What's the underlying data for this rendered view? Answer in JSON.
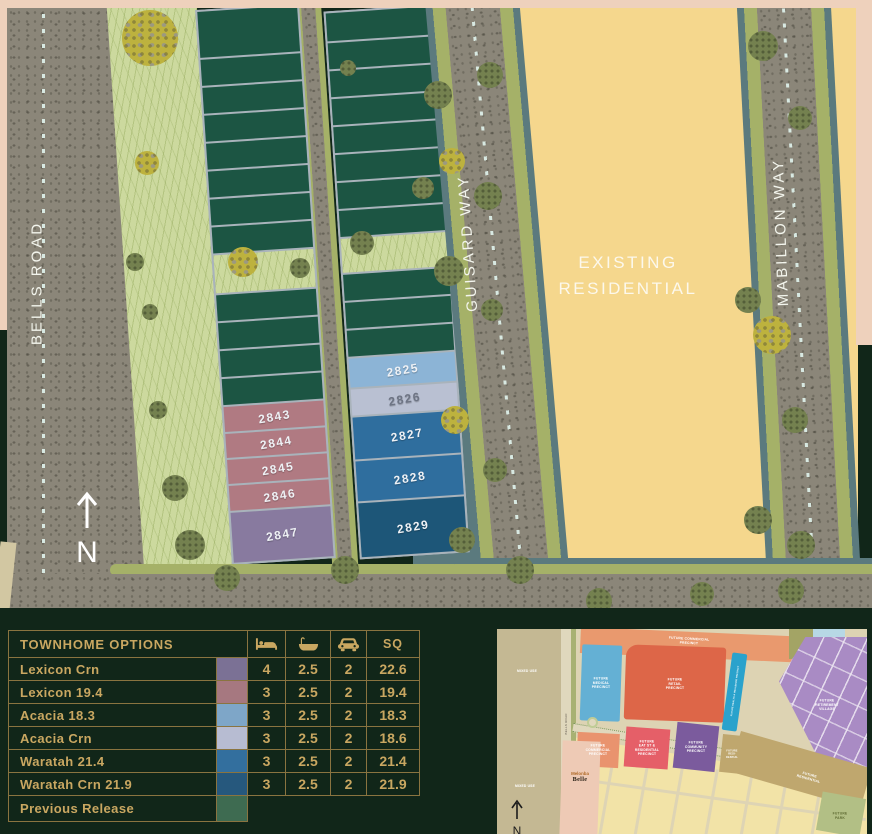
{
  "palette": {
    "page_bg": "#112619",
    "gold_text": "#c9a761",
    "gold_border": "#8a7440",
    "map_yellow": "#f5d78d",
    "map_pink_frame": "#eed1bc",
    "road_gray": "#8b8679",
    "grass_green": "#ccd99e",
    "lot_green": "#1c5543",
    "verge_olive": "#a5b168",
    "edge_teal": "#5b7a7e"
  },
  "map": {
    "road_labels": {
      "bells": "BELLS ROAD",
      "guisard": "GUISARD WAY",
      "mabillon": "MABILLON WAY"
    },
    "area_label": {
      "line1": "EXISTING",
      "line2": "RESIDENTIAL"
    },
    "north_label": "N",
    "lots": {
      "left": [
        {
          "id": "2843",
          "color": "#b07a82"
        },
        {
          "id": "2844",
          "color": "#b07a82"
        },
        {
          "id": "2845",
          "color": "#b07a82"
        },
        {
          "id": "2846",
          "color": "#b07a82"
        },
        {
          "id": "2847",
          "color": "#887a9f"
        }
      ],
      "right": [
        {
          "id": "2825",
          "color": "#8cb4d6"
        },
        {
          "id": "2826",
          "color": "#b9c0d2"
        },
        {
          "id": "2827",
          "color": "#2f6e9e"
        },
        {
          "id": "2828",
          "color": "#2f6e9e"
        },
        {
          "id": "2829",
          "color": "#1d5678"
        }
      ]
    }
  },
  "table": {
    "title": "TOWNHOME OPTIONS",
    "sq_label": "SQ",
    "icons": [
      "bed-icon",
      "bath-icon",
      "car-icon"
    ],
    "rows": [
      {
        "name": "Lexicon Crn",
        "color": "#7b7195",
        "beds": "4",
        "baths": "2.5",
        "cars": "2",
        "sq": "22.6"
      },
      {
        "name": "Lexicon 19.4",
        "color": "#a67880",
        "beds": "3",
        "baths": "2.5",
        "cars": "2",
        "sq": "19.4"
      },
      {
        "name": "Acacia 18.3",
        "color": "#7ea6c8",
        "beds": "3",
        "baths": "2.5",
        "cars": "2",
        "sq": "18.3"
      },
      {
        "name": "Acacia Crn",
        "color": "#b7bcd2",
        "beds": "3",
        "baths": "2.5",
        "cars": "2",
        "sq": "18.6"
      },
      {
        "name": "Waratah 21.4",
        "color": "#336f9e",
        "beds": "3",
        "baths": "2.5",
        "cars": "2",
        "sq": "21.4"
      },
      {
        "name": "Waratah Crn 21.9",
        "color": "#26587d",
        "beds": "3",
        "baths": "2.5",
        "cars": "2",
        "sq": "21.9"
      }
    ],
    "footer_row": {
      "name": "Previous Release",
      "color": "#3e6b51"
    }
  },
  "minimap": {
    "labels": {
      "mixed_use_1": "MIXED USE",
      "mixed_use_2": "MIXED USE",
      "bells_road": "BELLS ROAD",
      "commercial_top": "FUTURE COMMERCIAL\nPRECINCT",
      "medical": "FUTURE\nMEDICAL\nPRECINCT",
      "retail": "FUTURE\nRETAIL\nPRECINCT",
      "wellbeing": "FUTURE HEALTH & WELLBEING PRECINCT",
      "retirement": "FUTURE\nRETIREMENT\nVILLAGE",
      "commercial_2": "FUTURE\nCOMMERCIAL\nPRECINCT",
      "eat_st": "FUTURE\nEAT ST &\nRESIDENTIAL\nPRECINCT",
      "community": "FUTURE\nCOMMUNITY\nPRECINCT",
      "residential_small": "FUTURE\nRESI-\nDENTIAL",
      "residential_big": "FUTURE\nRESIDENTIAL",
      "park": "FUTURE\nPARK",
      "logo_top": "Melonba",
      "logo_name": "Belle"
    }
  }
}
